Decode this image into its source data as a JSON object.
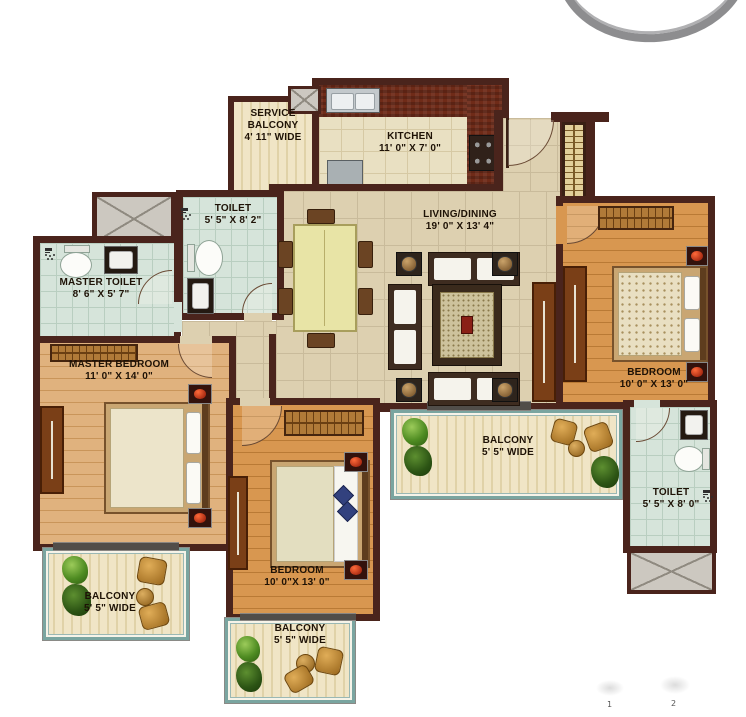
{
  "plan": {
    "type": "apartment-floor-plan",
    "rooms": [
      {
        "id": "service-balcony",
        "label": "SERVICE BALCONY",
        "dims": "4' 11\" WIDE"
      },
      {
        "id": "kitchen",
        "label": "KITCHEN",
        "dims": "11' 0\" X 7' 0\""
      },
      {
        "id": "toilet-top",
        "label": "TOILET",
        "dims": "5' 5\" X 8' 2\""
      },
      {
        "id": "master-toilet",
        "label": "MASTER TOILET",
        "dims": "8' 6\" X 5' 7\""
      },
      {
        "id": "living-dining",
        "label": "LIVING/DINING",
        "dims": "19' 0\" X 13' 4\""
      },
      {
        "id": "master-bedroom",
        "label": "MASTER BEDROOM",
        "dims": "11' 0\" X 14' 0\""
      },
      {
        "id": "bedroom-right",
        "label": "BEDROOM",
        "dims": "10' 0\" X 13' 0\""
      },
      {
        "id": "balcony-right",
        "label": "BALCONY",
        "dims": "5' 5\" WIDE"
      },
      {
        "id": "toilet-bottom",
        "label": "TOILET",
        "dims": "5' 5\" X 8' 0\""
      },
      {
        "id": "bedroom-bottom",
        "label": "BEDROOM",
        "dims": "10' 0\"X 13' 0\""
      },
      {
        "id": "balcony-left",
        "label": "BALCONY",
        "dims": "5' 5\" WIDE"
      },
      {
        "id": "balcony-bottom",
        "label": "BALCONY",
        "dims": "5' 5\" WIDE"
      }
    ],
    "scale_marks": [
      "1",
      "2"
    ],
    "icons": {
      "logo": "ring-arc",
      "shaft": "x-cross-box",
      "shower": "shower-head",
      "wc": "toilet-seat",
      "basin": "washbasin",
      "plant": "shrub",
      "door": "quarter-arc"
    },
    "colors": {
      "wall": "#4a241c",
      "living_tile": "#ddd0b0",
      "kitchen_tile": "#e9e0c2",
      "toilet_tile": "#d6e4da",
      "bedroom_wood": "#d89750",
      "master_wood": "#e0b27e",
      "balcony_floor": "#f0e5c6",
      "balcony_frame": "#7aa5a0",
      "counter_brick": "#6f2b18",
      "logo_gray": "#8d8d8f"
    }
  }
}
